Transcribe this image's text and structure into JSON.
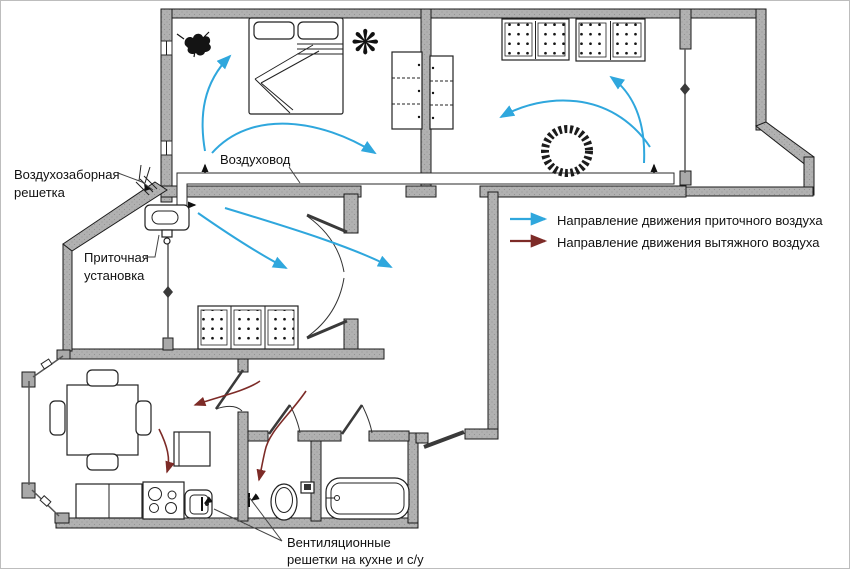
{
  "plan": {
    "labels": {
      "intake_grille_line1": "Воздухозаборная",
      "intake_grille_line2": "решетка",
      "duct": "Воздуховод",
      "supply_unit_line1": "Приточная",
      "supply_unit_line2": "установка",
      "vent_grilles_line1": "Вентиляционные",
      "vent_grilles_line2": "решетки на кухне и с/у"
    },
    "legend": {
      "supply": {
        "label": "Направление движения приточного воздуха",
        "color": "#2fa7dd"
      },
      "exhaust": {
        "label": "Направление движения вытяжного воздуха",
        "color": "#7d2b27"
      }
    },
    "colors": {
      "background": "#ffffff",
      "wall_fill": "#b1b1b1",
      "wall_outline": "#1b1b1b",
      "supply_arrow": "#2fa7dd",
      "exhaust_arrow": "#7d2b27"
    }
  }
}
